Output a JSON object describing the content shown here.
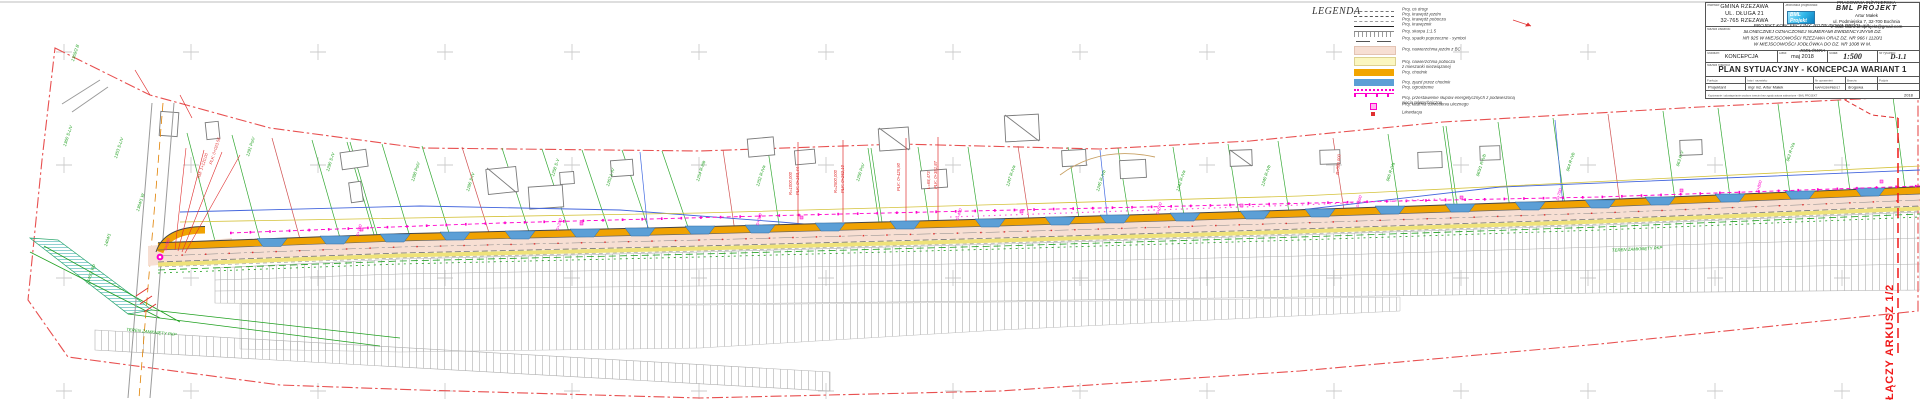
{
  "sheet": {
    "joins_label": "ŁĄCZY ARKUSZ 1/2"
  },
  "legend": {
    "title": "LEGENDA",
    "items": [
      {
        "label": "Proj. oś drogi"
      },
      {
        "label": "Proj. krawędź jezdni"
      },
      {
        "label": "Proj. krawędź pobocza"
      },
      {
        "label": "Proj. krawężnik"
      },
      {
        "label": "Proj. skarpa 1:1.5"
      },
      {
        "label": "Proj. spadki poprzeczne - symbol"
      },
      {
        "label": "Proj. nawierzchnia jezdni z BC"
      },
      {
        "label": "Proj. nawierzchnia pobocza\nz mieszanki niezwiązanej"
      },
      {
        "label": "Proj. chodnik"
      },
      {
        "label": "Proj. zjazd przez chodnik"
      },
      {
        "label": "Proj. ogrodzenie"
      },
      {
        "label": "Proj. przestawienie słupów energetycznych z podwieszoną\nsiecią teletechniczną"
      },
      {
        "label": "Proj. latarnia oświetlenia ulicznego"
      },
      {
        "label": "Likwidacja"
      }
    ]
  },
  "title_block": {
    "investor": {
      "label": "Inwestor:",
      "name": "GMINA RZEZAWA",
      "addr1": "UL. DŁUGA 21",
      "addr2": "32-765 RZEZAWA"
    },
    "designer": {
      "label": "Jednostka projektowa:",
      "line1": "PRACOWNIA INŻYNIERSKA",
      "line2": "BML PROJEKT",
      "line3": "Artur Małek",
      "line4": "ul. Podmiejska 7, 32-700 Bochnia",
      "line5": "e-mail: biuro.bmlprojekt@gmail.com",
      "logo1": "BML",
      "logo2": "Projekt"
    },
    "task": {
      "label": "Nazwa zadania:",
      "text": "PROJEKT KONCEPCYJNY: ROZBUDOWA DROGI - UL. SŁONECZNEJ OZNACZONEJ NUMERAMI EWIDENCYJNYMI DZ. NR 925 W MIEJSCOWOŚCI RZEZAWA ORAZ DZ. NR 966 I 1120/1 W MIEJSCOWOŚCI JODŁÓWKA DO DZ. NR 1008 W M. JODŁÓWKA"
    },
    "stage": {
      "label": "Stadium:",
      "value": "KONCEPCJA"
    },
    "date": {
      "label": "Data:",
      "value": "maj 2018"
    },
    "scale": {
      "label": "Skala:",
      "value": "1:500"
    },
    "number": {
      "label": "Nr rysunku:",
      "value": "D-1.1"
    },
    "drawing": {
      "label": "Nazwa rysunku:",
      "value": "PLAN SYTUACYJNY - KONCEPCJA WARIANT 1"
    },
    "persons": {
      "h_role": "Funkcja",
      "h_name": "Imię i nazwisko",
      "h_lic": "Nr uprawnień",
      "h_branch": "Branża",
      "h_sign": "Podpis",
      "role": "Projektant",
      "name": "mgr inż. Artur Małek",
      "lic": "MAP/0299/PBD/17",
      "branch": "drogowa"
    },
    "fine_print": "Kopiowanie i udostępnianie osobom trzecim bez zgody autora zabronione - BML PROJEKT",
    "year": "2018"
  },
  "stations": [
    "0+000",
    "0+100",
    "0+200",
    "0+300",
    "0+400",
    "0+500",
    "0+600",
    "0+700",
    "0+800"
  ],
  "parcels": [
    "1369/2 B",
    "1360 S-LIV",
    "1353 S-LIV",
    "1364/1 W",
    "1464/1",
    "1448/2 Wp",
    "1291 PsIV",
    "1290 S-IV",
    "1288 PsIV",
    "1286 S-IV",
    "1258 S-V",
    "1262 Ł-IV",
    "1254 R-IIIb",
    "1252 R-IVa",
    "1250 PsV",
    "1247 R-IVa",
    "1245 R-IVb",
    "1242 R-IVa",
    "1240 R-IVb",
    "966 R-IVa",
    "965/1 R-IVb",
    "964 R-IVb",
    "963 R-V",
    "962 R-IVa"
  ],
  "annotations": [
    "PLK: 0+023.56",
    "KM: 1+120,00",
    "R=1000,000",
    "PLK: 0+153,44",
    "R=2500,000",
    "PLK: 0+262,10",
    "PLK: 0+425,90",
    "Ł=68,473",
    "PLK: 0+381,87",
    "R=500,000"
  ],
  "notes": {
    "pkp_left": "TEREN ZAMKNIĘTY PKP",
    "pkp_right": "TEREN ZAMKNIĘTY PKP"
  },
  "colors": {
    "roadway": "#F7DFD3",
    "shoulder": "#FBF7C0",
    "sidewalk": "#F2A500",
    "driveway": "#5C9FD6",
    "power": "#FF00CC",
    "cadastral": "#1FA01F",
    "boundary": "#E85050",
    "join": "#F01818"
  }
}
